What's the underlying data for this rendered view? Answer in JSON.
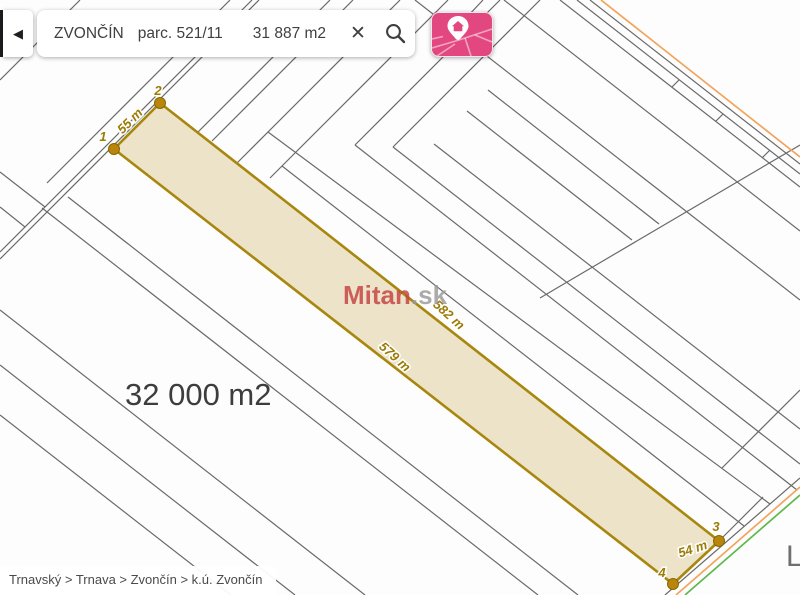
{
  "colors": {
    "pink": "#e2487f",
    "gold": "#a8870e",
    "goldDark": "#b8860b",
    "labelGold": "#9c7c04",
    "parcelFill": "#ece3c9",
    "line": "#6a6a6a",
    "orange": "#f2a45c",
    "green": "#5cb94c",
    "text": "#3f4043"
  },
  "toolbar": {
    "back_icon": "◀",
    "search_region": "ZVONČÍN",
    "search_parcel": "parc. 521/11",
    "search_area": "31 887 m2",
    "clear_icon": "✕"
  },
  "map": {
    "area_label": "32 000 m2",
    "watermark_brand": "Mitan",
    "watermark_tld": ".sk",
    "clipped_label": "L",
    "parcel": {
      "points": [
        {
          "label": "1"
        },
        {
          "label": "2"
        },
        {
          "label": "3"
        },
        {
          "label": "4"
        }
      ],
      "edges": [
        {
          "label": "55 m"
        },
        {
          "label": "582 m"
        },
        {
          "label": "579 m"
        },
        {
          "label": "54 m"
        }
      ]
    }
  },
  "breadcrumb": "Trnavský > Trnava > Zvončín > k.ú. Zvončín"
}
